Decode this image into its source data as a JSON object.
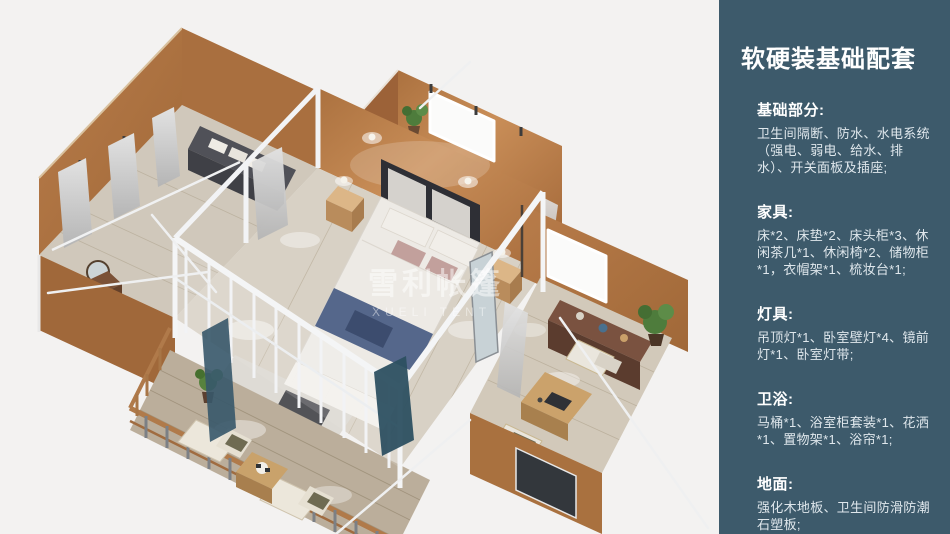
{
  "sidebar": {
    "title": "软硬装基础配套",
    "sections": [
      {
        "heading": "基础部分:",
        "body": "卫生间隔断、防水、水电系统（强电、弱电、给水、排水）、开关面板及插座;"
      },
      {
        "heading": "家具:",
        "body": "床*2、床垫*2、床头柜*3、休闲茶几*1、休闲椅*2、储物柜*1，衣帽架*1、梳妆台*1;"
      },
      {
        "heading": "灯具:",
        "body": "吊顶灯*1、卧室壁灯*4、镜前灯*1、卧室灯带;"
      },
      {
        "heading": "卫浴:",
        "body": "马桶*1、浴室柜套装*1、花洒*1、置物架*1、浴帘*1;"
      },
      {
        "heading": "地面:",
        "body": "强化木地板、卫生间防滑防潮石塑板;"
      }
    ],
    "colors": {
      "panel_bg": "#3d5a6b",
      "title": "#ffffff",
      "body_text": "#dfe7ec"
    }
  },
  "illustration": {
    "watermark_cn": "雪利帐篷",
    "watermark_en": "XUELI TENT",
    "colors": {
      "background": "#f3f2f1",
      "wall_caramel": "#b87c4a",
      "wall_lit": "#c98e58",
      "floor_wood": "#d6cfc3",
      "deck_wood": "#bbae9b",
      "frame_white": "#f2f3f5",
      "bed_runner": "#55678b",
      "plant_green": "#4e7c3c",
      "cabinet_brown": "#6f4936",
      "curtain_gray": "#cfcfcf",
      "glass_teal": "#2d5061"
    }
  }
}
